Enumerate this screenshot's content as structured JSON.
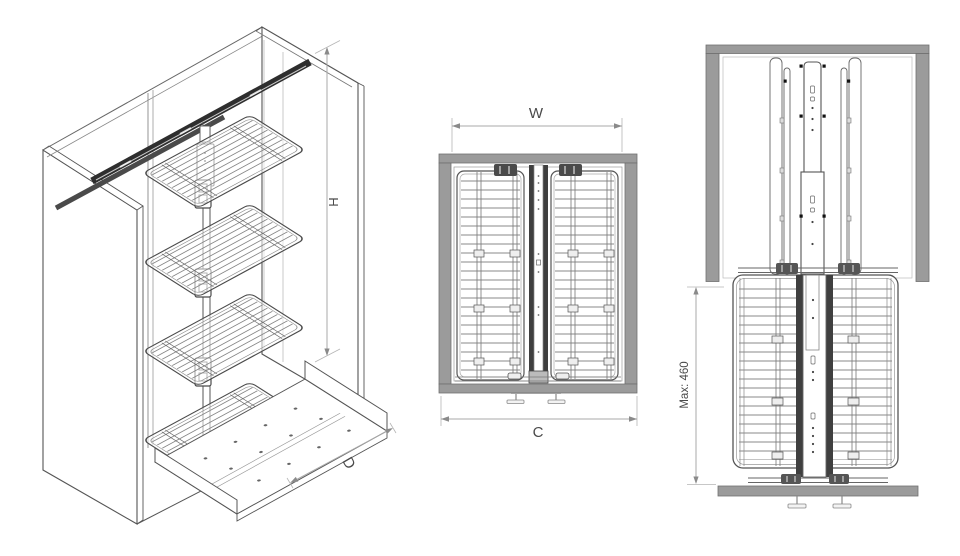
{
  "drawing": {
    "views": {
      "isometric": {
        "dim_height": "H",
        "dim_depth": "D"
      },
      "front": {
        "dim_width": "W",
        "dim_cabinet": "C"
      },
      "side": {
        "dim_max": "Max: 460"
      }
    },
    "colors": {
      "background": "#ffffff",
      "panel_gray": "#9b9b9b",
      "panel_gray_border": "#707070",
      "line": "#555555",
      "wire": "#8a8a8a",
      "rail_dark": "#3f3f3f",
      "dim_line": "#a8a8a8",
      "dim_text": "#4a4a4a"
    }
  }
}
